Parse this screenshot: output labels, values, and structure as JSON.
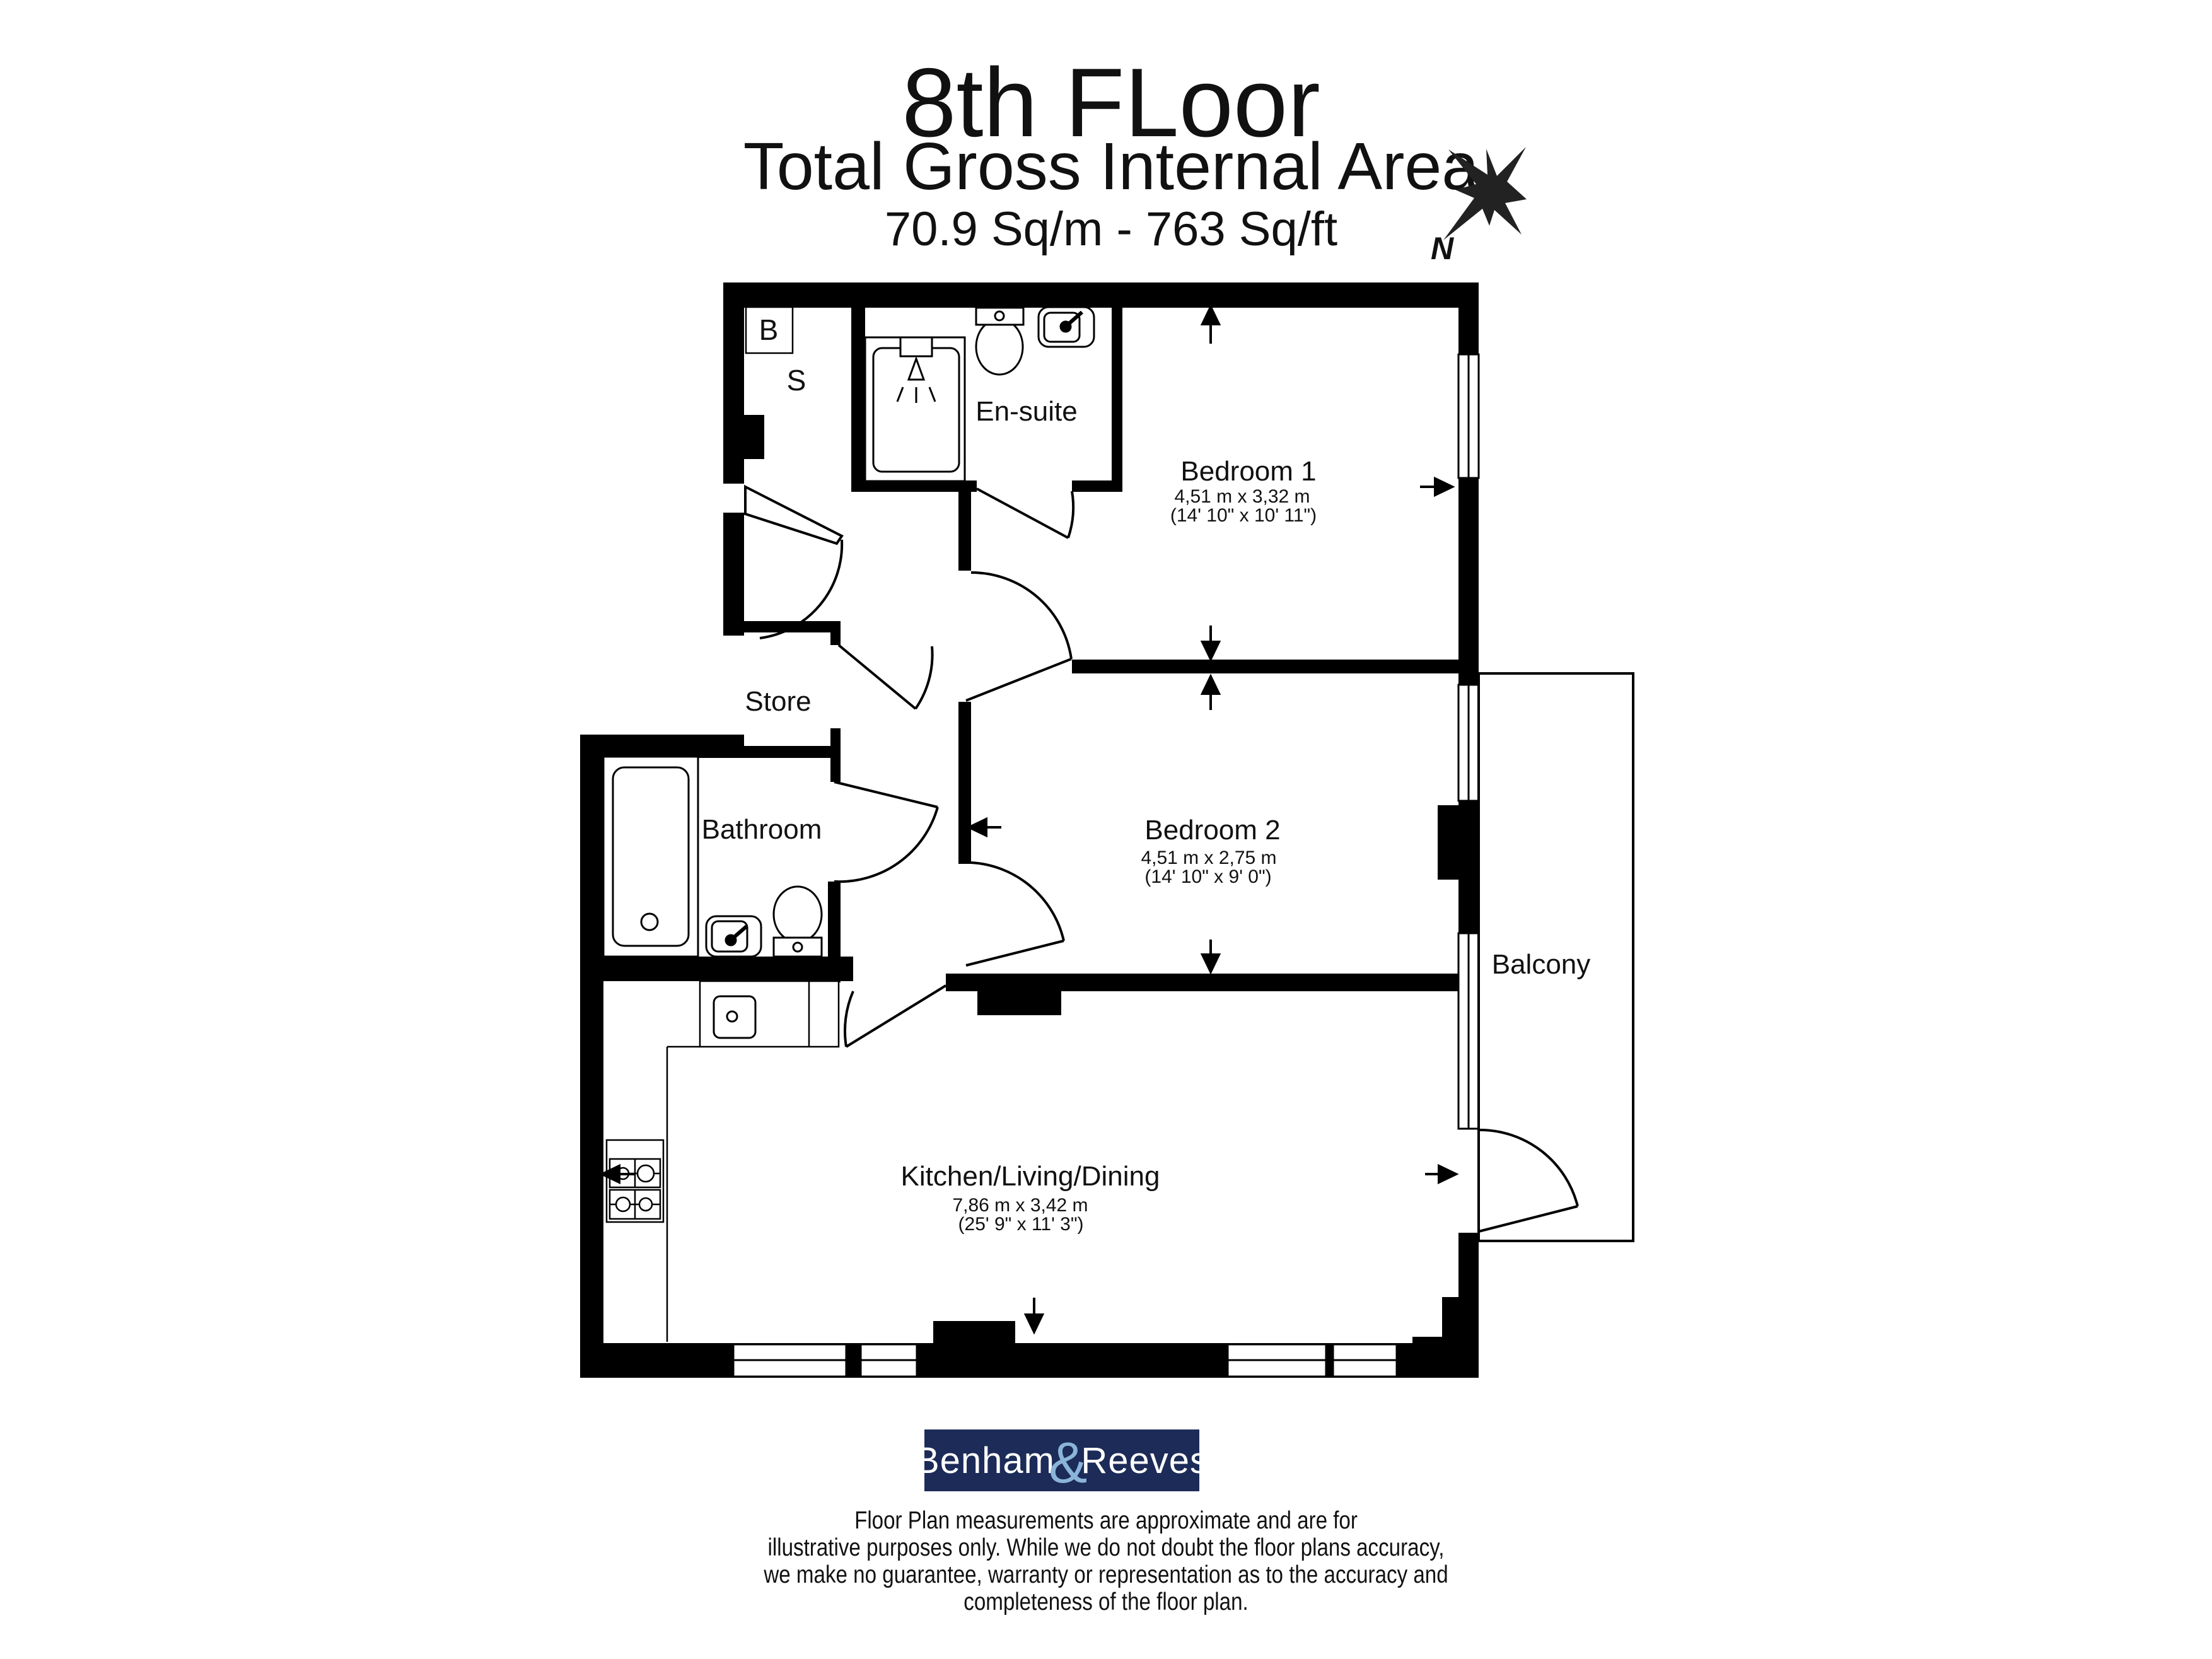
{
  "title": {
    "floor": "8th FLoor",
    "subtitle": "Total Gross Internal Area",
    "area": "70.9 Sq/m - 763 Sq/ft"
  },
  "compass": {
    "n": "N"
  },
  "rooms": {
    "bedroom1": {
      "name": "Bedroom 1",
      "metric": "4,51 m x 3,32 m",
      "imperial": "(14' 10\" x 10' 11\")"
    },
    "bedroom2": {
      "name": "Bedroom 2",
      "metric": "4,51 m x 2,75 m",
      "imperial": "(14' 10\" x 9' 0\")"
    },
    "kitchen": {
      "name": "Kitchen/Living/Dining",
      "metric": "7,86 m x 3,42 m",
      "imperial": "(25' 9\" x 11' 3\")"
    },
    "ensuite": {
      "name": "En-suite"
    },
    "bathroom": {
      "name": "Bathroom"
    },
    "store": {
      "name": "Store"
    },
    "balcony": {
      "name": "Balcony"
    },
    "closet": {
      "b": "B",
      "s": "S"
    }
  },
  "logo": {
    "part1": "Benham",
    "amp": "&",
    "part2": "Reeves"
  },
  "disclaimer": {
    "lines": [
      "Floor Plan measurements are approximate and are for",
      "illustrative purposes only.  While we do not doubt the floor plans accuracy,",
      "we make no guarantee, warranty or representation as to the accuracy and",
      "completeness of the floor plan."
    ]
  },
  "colors": {
    "logo_bg": "#1c2b58",
    "logo_text": "#ffffff",
    "logo_amp": "#8ab4d8",
    "star": "#222222",
    "line": "#000000"
  }
}
